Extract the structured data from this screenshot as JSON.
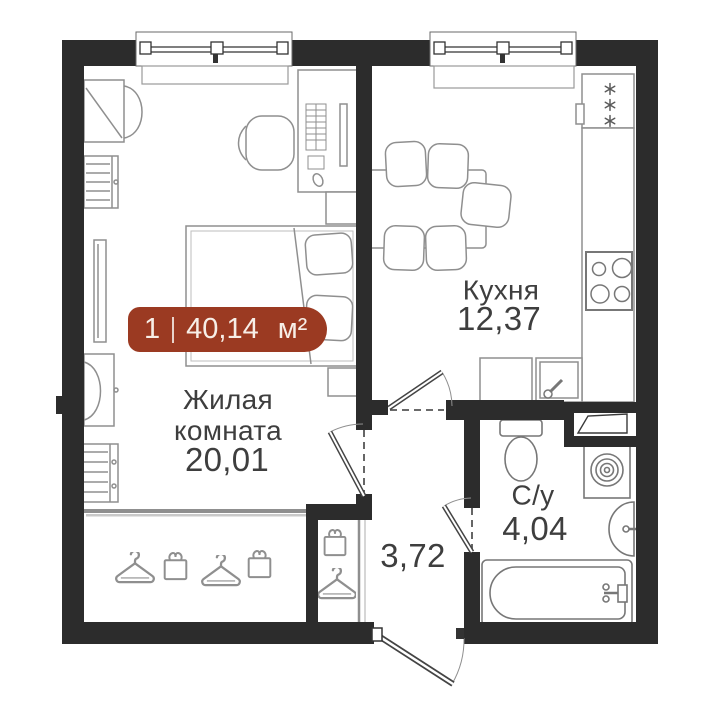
{
  "plan": {
    "type": "apartment-floor-plan",
    "badge": {
      "rooms_count": "1",
      "area_value": "40,14",
      "area_unit": "м²"
    },
    "rooms": {
      "living": {
        "label_line1": "Жилая",
        "label_line2": "комната",
        "area": "20,01"
      },
      "kitchen": {
        "label": "Кухня",
        "area": "12,37"
      },
      "hallway": {
        "area": "3,72"
      },
      "bathroom": {
        "label": "С/у",
        "area": "4,04"
      }
    },
    "icons": {
      "hanger": "hanger-icon (wardrobe)",
      "box": "storage-box-icon (wardrobe)",
      "snowflake": "snowflake-icon (fridge)"
    }
  },
  "colors": {
    "wall": "#2C2C2C",
    "furniture_line": "#8F8F8F",
    "fixture_line": "#777777",
    "label_text": "#3E3E3E",
    "badge_bg": "#9B3A22",
    "badge_text": "#F7EEE7"
  }
}
